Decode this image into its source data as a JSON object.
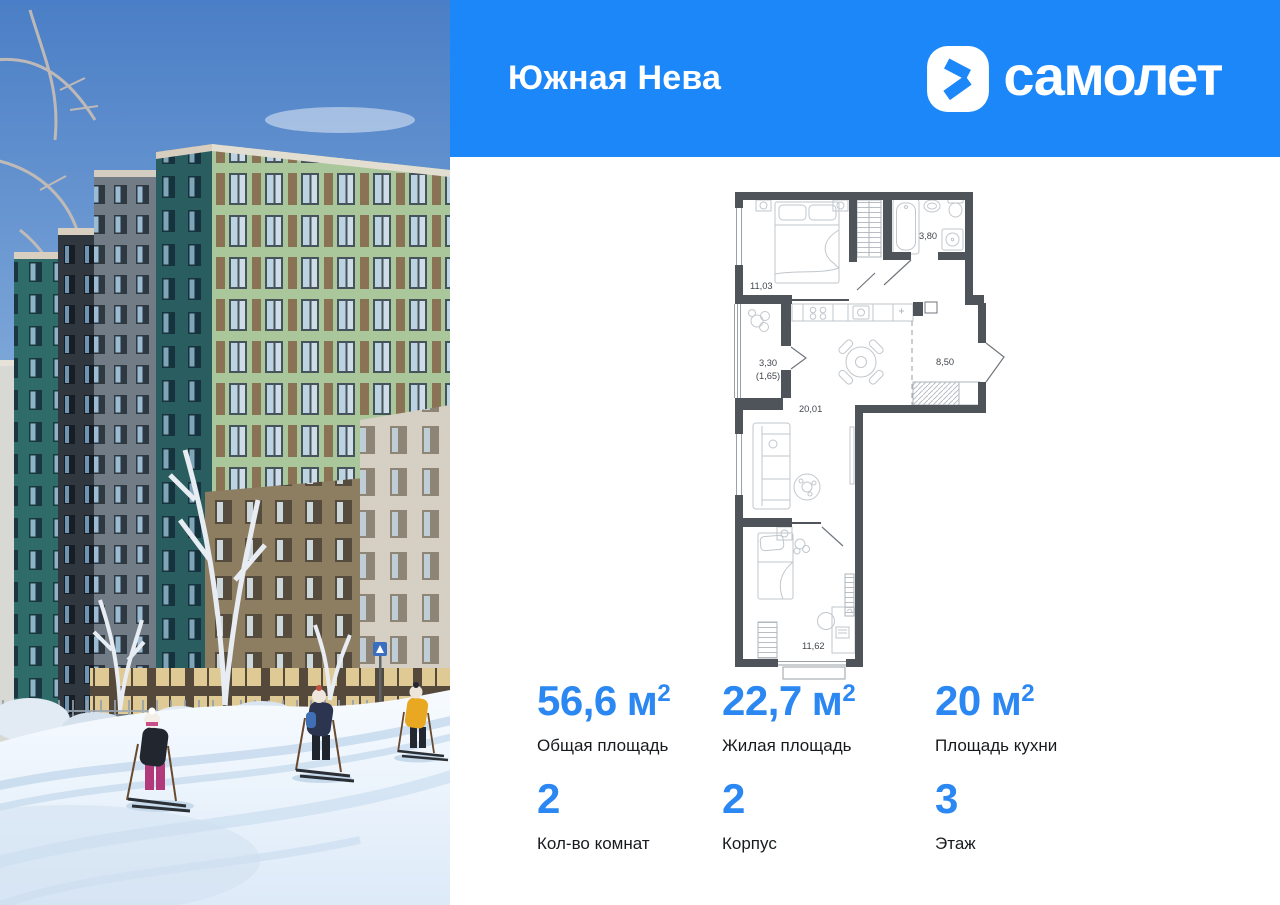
{
  "header": {
    "project_name": "Южная Нева",
    "brand_name": "самолет"
  },
  "floor_plan": {
    "rooms": [
      {
        "name": "bedroom-1",
        "area_label": "11,03"
      },
      {
        "name": "bathroom",
        "area_label": "3,80"
      },
      {
        "name": "balcony",
        "area_label": "3,30",
        "area_label_secondary": "(1,65)"
      },
      {
        "name": "kitchen-living-room",
        "area_label": "20,01"
      },
      {
        "name": "hallway",
        "area_label": "8,50"
      },
      {
        "name": "bedroom-2",
        "area_label": "11,62"
      }
    ]
  },
  "specs": {
    "cells": [
      {
        "value": "56,6",
        "unit": "м",
        "unit_sup": "2",
        "label": "Общая площадь"
      },
      {
        "value": "22,7",
        "unit": "м",
        "unit_sup": "2",
        "label": "Жилая площадь"
      },
      {
        "value": "20",
        "unit": "м",
        "unit_sup": "2",
        "label": "Площадь кухни"
      },
      {
        "value": "2",
        "label": "Кол-во комнат"
      },
      {
        "value": "2",
        "label": "Корпус"
      },
      {
        "value": "3",
        "label": "Этаж"
      }
    ]
  },
  "colors": {
    "header_blue": "#1B87F8",
    "accent_blue": "#2B87F1",
    "plan_wall": "#4E545A"
  }
}
